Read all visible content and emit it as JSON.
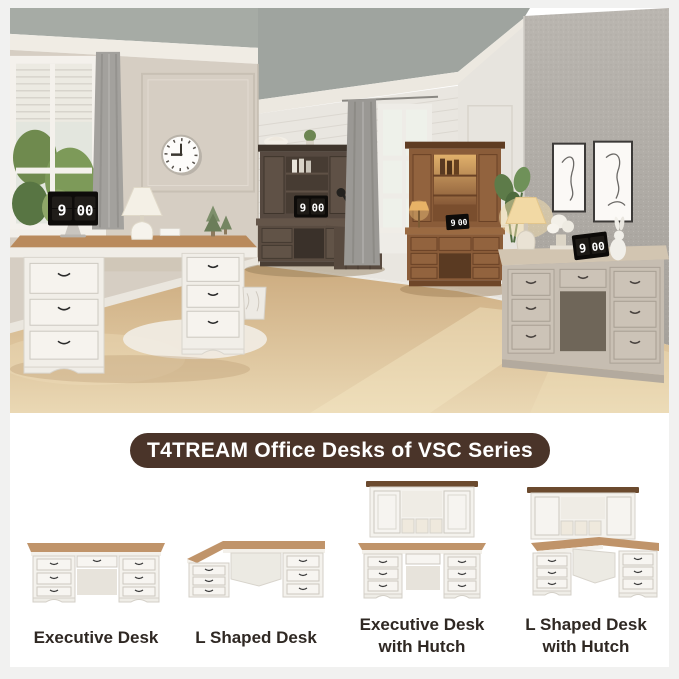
{
  "banner": {
    "title": "T4TREAM Office Desks of VSC Series"
  },
  "scene": {
    "flip_clock": {
      "hour": "9",
      "minute": "00"
    }
  },
  "products": [
    {
      "label": "Executive Desk"
    },
    {
      "label": "L Shaped Desk"
    },
    {
      "label": "Executive Desk with Hutch"
    },
    {
      "label": "L Shaped Desk with Hutch"
    }
  ],
  "colors": {
    "banner_bg": "#4a3429",
    "banner_text": "#ffffff",
    "label_text": "#2f2823",
    "wood_top": "#c0946a",
    "floor": "#e0c49c"
  }
}
